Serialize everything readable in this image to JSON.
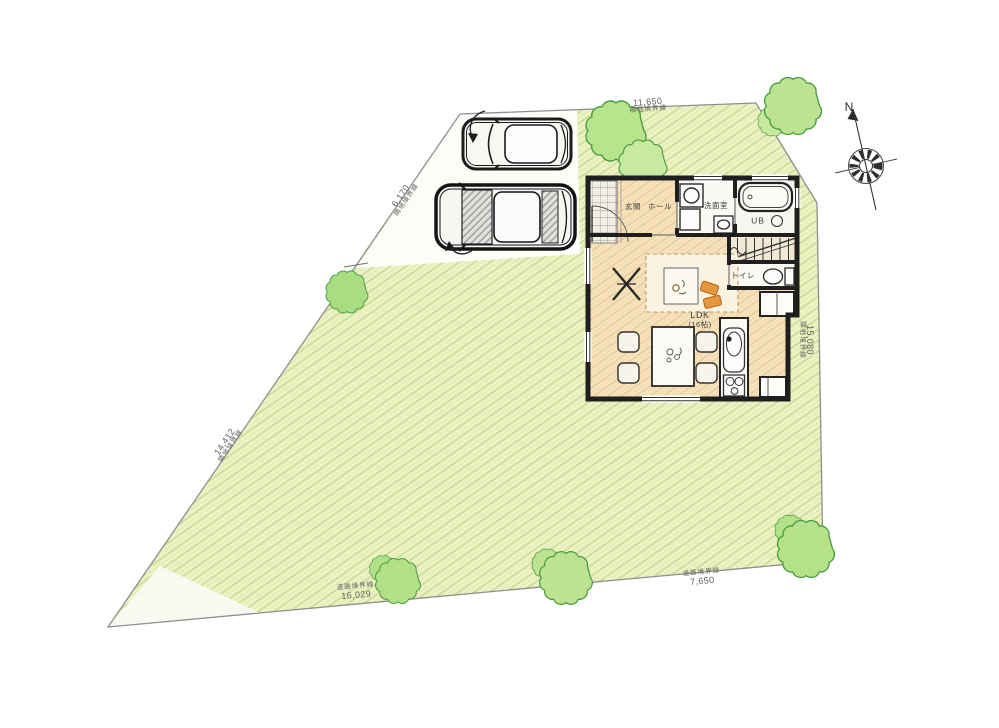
{
  "site": {
    "boundaries": [
      {
        "id": "top",
        "type": "隣地境界線",
        "length": "11,650"
      },
      {
        "id": "left_upper",
        "type": "隣地境界線",
        "length": "6,170"
      },
      {
        "id": "left_lower",
        "type": "隣地境界線",
        "length": "14,412"
      },
      {
        "id": "right",
        "type": "隣地境界線",
        "length": "15,080"
      },
      {
        "id": "road_left",
        "type": "道路境界線",
        "length": "16,029"
      },
      {
        "id": "road_right",
        "type": "道路境界線",
        "length": "7,650"
      }
    ]
  },
  "compass": {
    "north": "N"
  },
  "floor_plan": {
    "rooms": {
      "entrance": "玄関",
      "hall": "ホール",
      "washroom": "洗面室",
      "bath": "UB",
      "toilet": "トイレ",
      "ldk": "LDK",
      "ldk_size": "(16帖)"
    }
  },
  "colors": {
    "lawn": "#edf2c6",
    "lawn_hatch": "#cfe09b",
    "wood_floor": "#f6e2bb",
    "wood_hatch": "#ecd0a2",
    "wall": "#1f1f1f",
    "tree_fill": "#bce391",
    "tree_stroke": "#4a9c3e",
    "accent_orange": "#e0862f",
    "boundary_line": "#8f8f8f",
    "dimension_text": "#5f5f5f"
  }
}
